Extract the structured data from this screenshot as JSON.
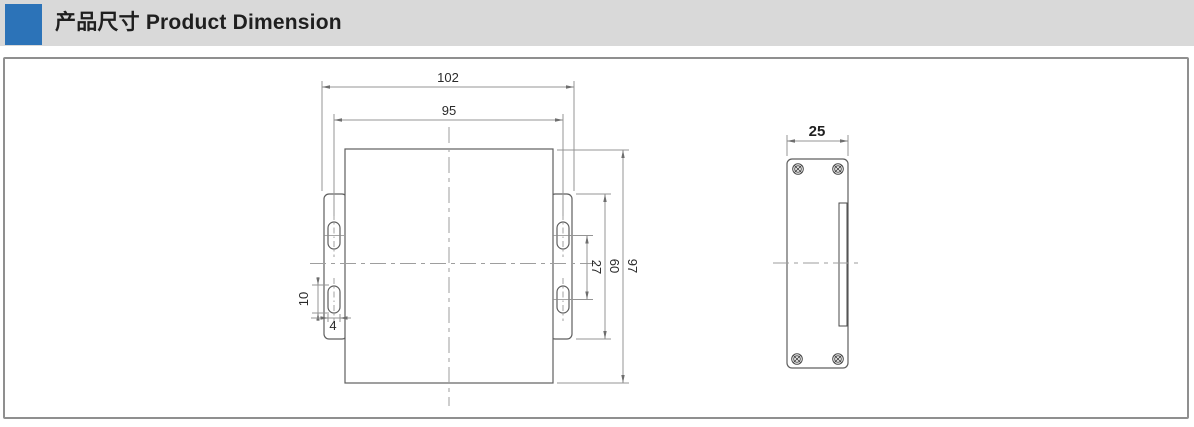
{
  "header": {
    "title": "产品尺寸 Product Dimension",
    "accent_color": "#2c73b8"
  },
  "drawing": {
    "front_view": {
      "dims": {
        "overall_width": "102",
        "mount_hole_span": "95",
        "overall_height": "97",
        "flange_height": "60",
        "slot_spacing": "27",
        "slot_length": "10",
        "slot_width": "4"
      }
    },
    "side_view": {
      "dims": {
        "depth": "25"
      }
    }
  }
}
